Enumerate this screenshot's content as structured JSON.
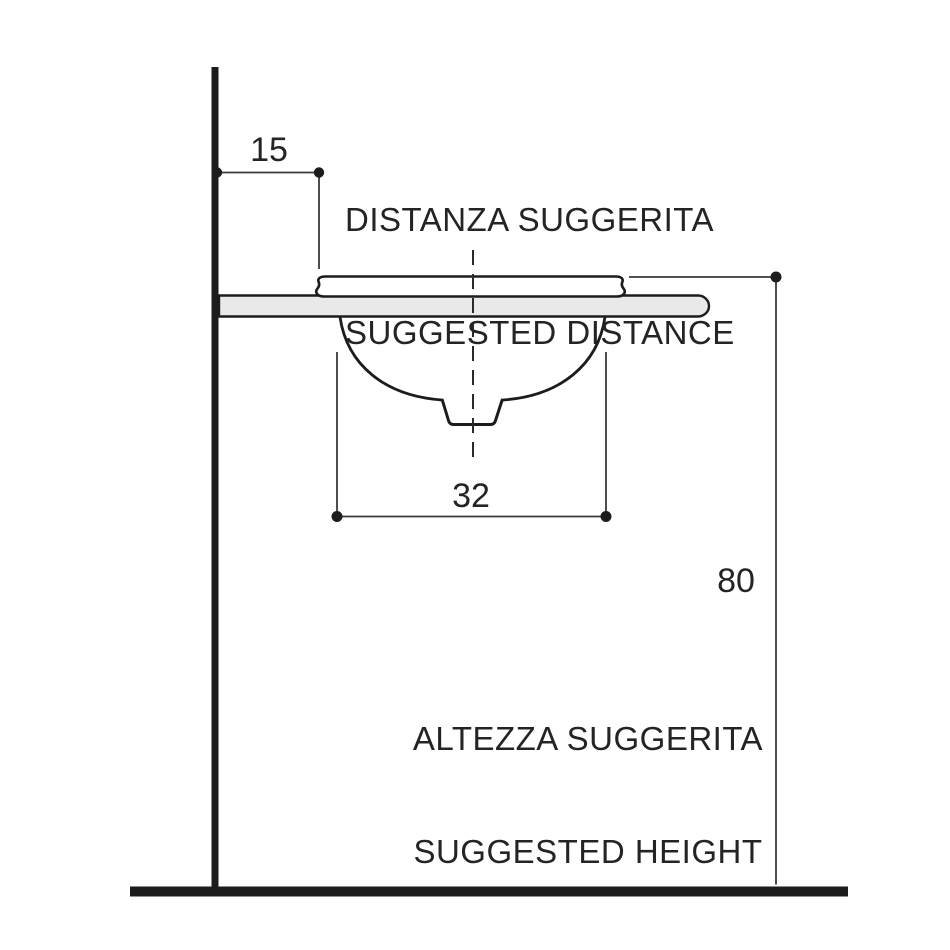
{
  "diagram": {
    "type": "technical-installation-drawing",
    "subject": "undermount washbasin side section with suggested installation dimensions",
    "dimensions": {
      "wall_distance": {
        "value": "15"
      },
      "basin_width": {
        "value": "32"
      },
      "floor_height": {
        "value": "80"
      }
    },
    "labels": {
      "distance_it": "DISTANZA SUGGERITA",
      "distance_en": "SUGGESTED DISTANCE",
      "height_it": "ALTEZZA SUGGERITA",
      "height_en": "SUGGESTED HEIGHT"
    },
    "colors": {
      "line": "#1c1c1c",
      "thin_line": "#3a3a3a",
      "countertop_fill": "#e9e9e9",
      "fixture_fill": "#ffffff",
      "background": "#ffffff"
    }
  }
}
